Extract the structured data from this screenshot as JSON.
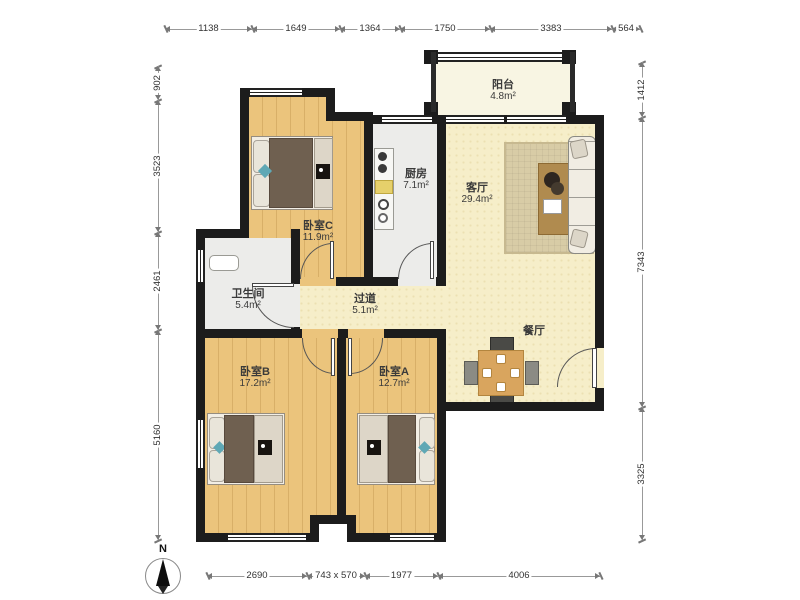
{
  "rooms": {
    "balcony": {
      "name": "阳台",
      "area": "4.8m²"
    },
    "kitchen": {
      "name": "厨房",
      "area": "7.1m²"
    },
    "living": {
      "name": "客厅",
      "area": "29.4m²"
    },
    "bedroomC": {
      "name": "卧室C",
      "area": "11.9m²"
    },
    "bathroom": {
      "name": "卫生间",
      "area": "5.4m²"
    },
    "hallway": {
      "name": "过道",
      "area": "5.1m²"
    },
    "dining": {
      "name": "餐厅",
      "area": ""
    },
    "bedroomB": {
      "name": "卧室B",
      "area": "17.2m²"
    },
    "bedroomA": {
      "name": "卧室A",
      "area": "12.7m²"
    }
  },
  "dimensions": {
    "top": [
      "1138",
      "1649",
      "1364",
      "1750",
      "3383",
      "564"
    ],
    "left": [
      "902",
      "3523",
      "2461",
      "5160"
    ],
    "right": [
      "1412",
      "7343",
      "3325"
    ],
    "bottom": [
      "2690",
      "743 x 570",
      "1977",
      "4006"
    ]
  },
  "compass": {
    "label": "N"
  },
  "colors": {
    "wall": "#1c1c1c",
    "wood_floor": "#ebc47c",
    "living_floor": "#f6eec9",
    "tile_floor": "#ececea",
    "balcony_floor": "#f8f5e3",
    "duvet": "#6f6050",
    "rug": "#d8cca6"
  }
}
